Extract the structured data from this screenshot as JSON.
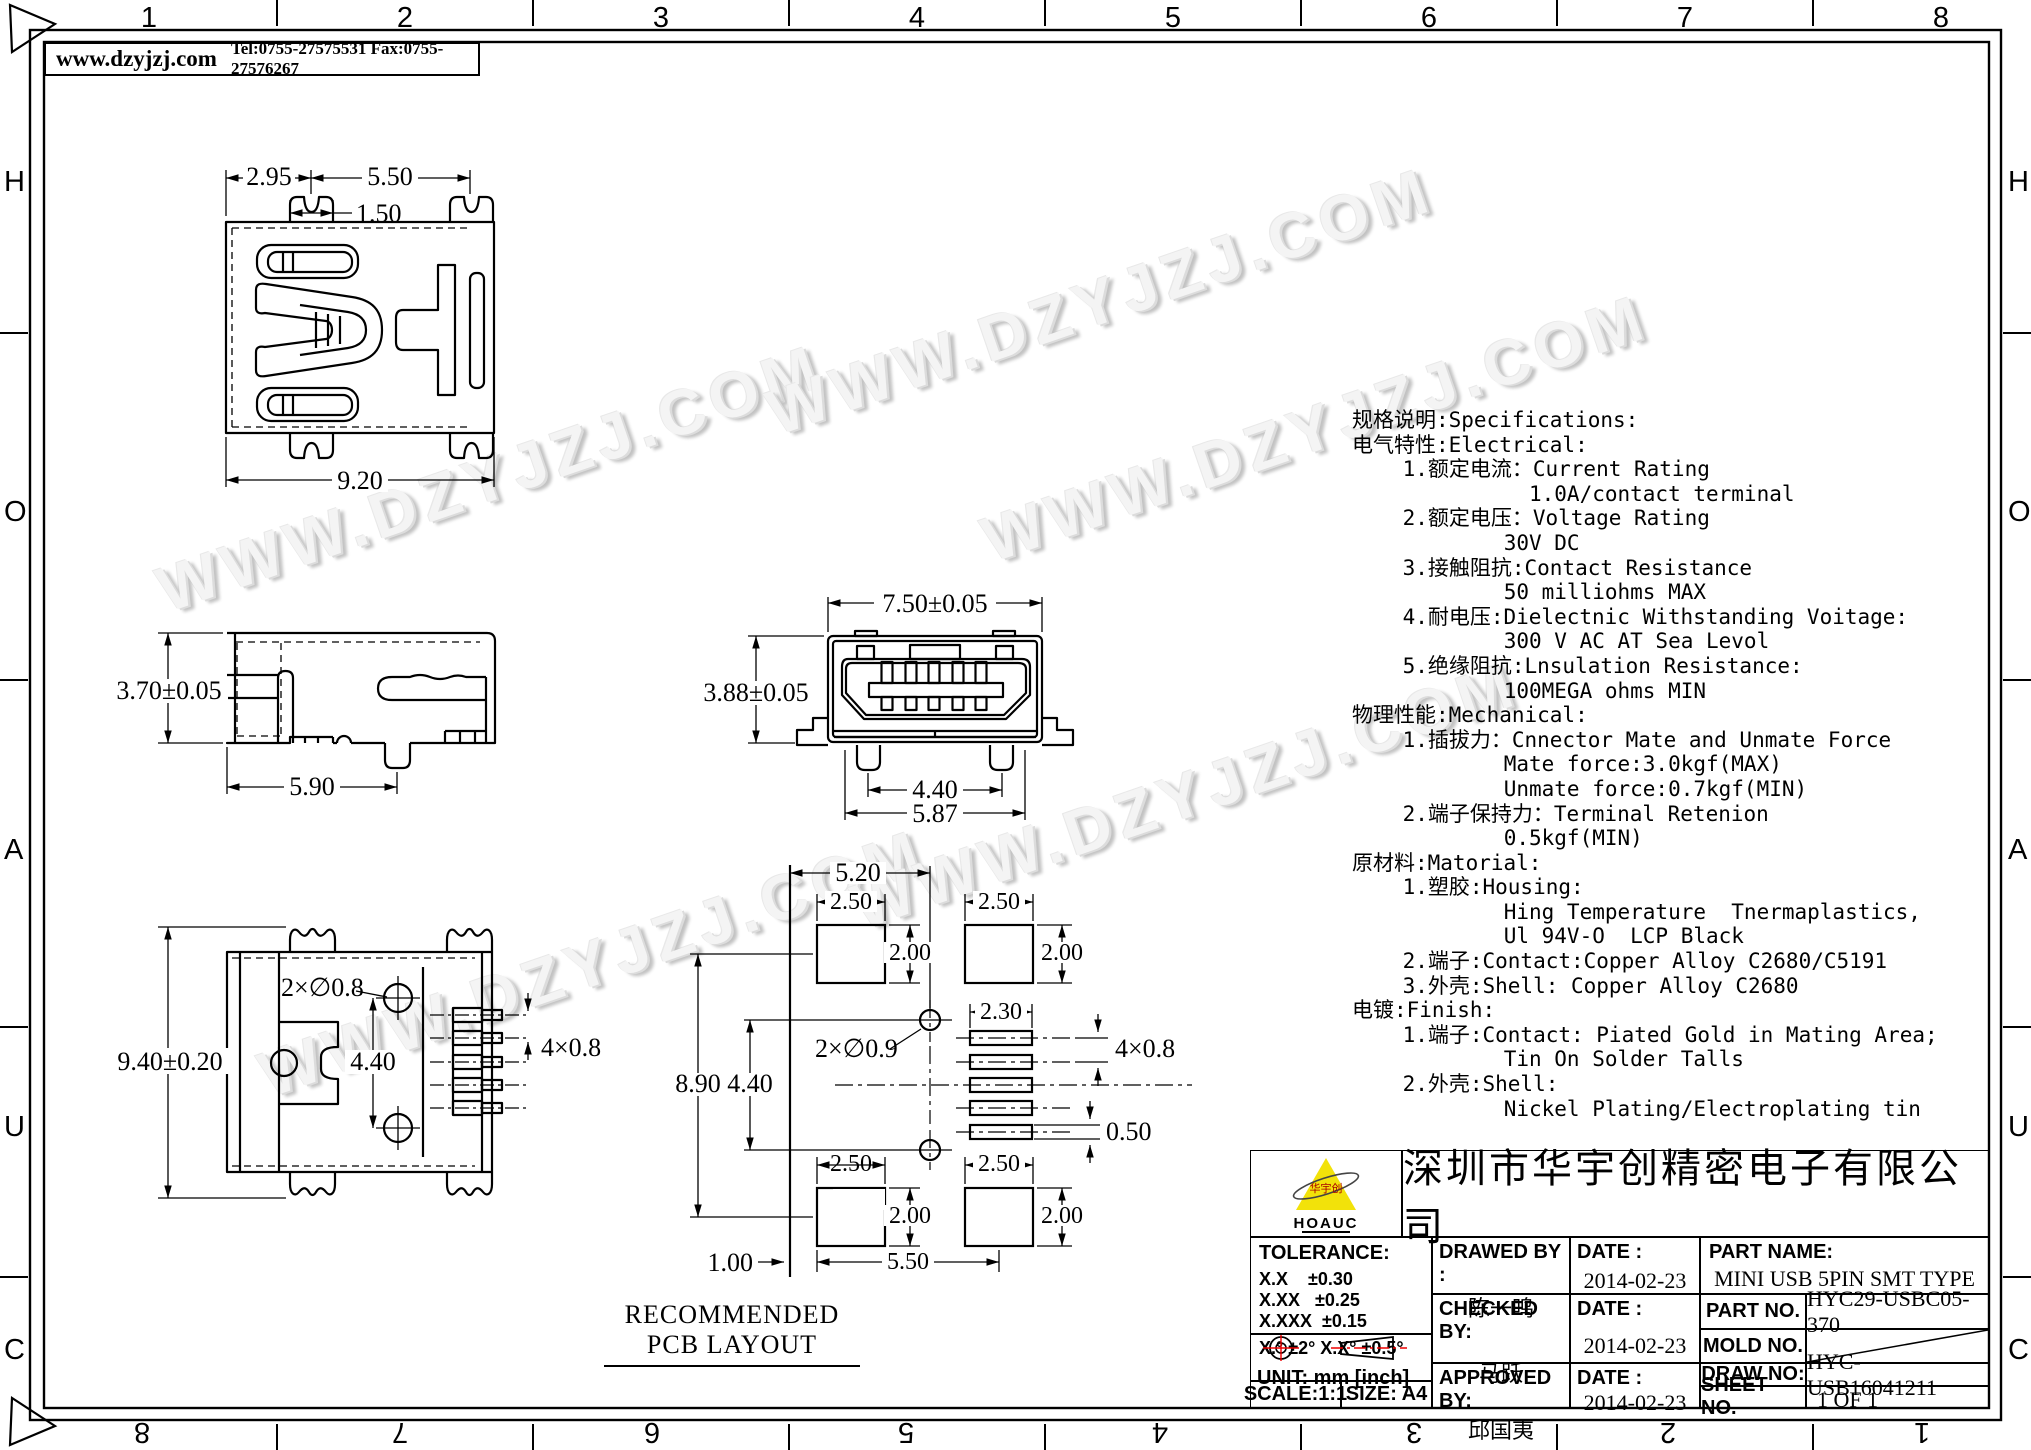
{
  "sheet": {
    "header": {
      "website": "www.dzyjzj.com",
      "contact": "Tel:0755-27575531  Fax:0755-27576267"
    },
    "frame": {
      "top_numbers": [
        "1",
        "2",
        "3",
        "4",
        "5",
        "6",
        "7",
        "8"
      ],
      "bottom_numbers": [
        "8",
        "7",
        "6",
        "5",
        "4",
        "3",
        "2",
        "1"
      ],
      "row_letters": [
        "H",
        "O",
        "A",
        "U",
        "C"
      ]
    },
    "watermark": "WWW.DZYJZJ.COM"
  },
  "views": {
    "top": {
      "d295": "2.95",
      "d550": "5.50",
      "d150": "1.50",
      "d920": "9.20"
    },
    "side": {
      "d370": "3.70±0.05",
      "d590": "5.90"
    },
    "front": {
      "d750": "7.50±0.05",
      "d388": "3.88±0.05",
      "d440": "4.40",
      "d587": "5.87"
    },
    "bottom": {
      "d940": "9.40±0.20",
      "holes": "2×∅0.8",
      "d440": "4.40",
      "pitch": "4×0.8"
    },
    "pcb": {
      "caption": "RECOMMENDED PCB LAYOUT",
      "d520": "5.20",
      "d250": "2.50",
      "d200": "2.00",
      "d230": "2.30",
      "holes": "2×∅0.9",
      "d890": "8.90",
      "d440": "4.40",
      "pitch": "4×0.8",
      "d050": "0.50",
      "d100": "1.00",
      "d550": "5.50"
    }
  },
  "specs": {
    "lines": [
      "规格说明:Specifications:",
      "电气特性:Electrical:",
      "    1.额定电流：Current Rating",
      "              1.0A/contact terminal",
      "    2.额定电压：Voltage Rating",
      "            30V DC",
      "    3.接触阻抗:Contact Resistance",
      "            50 milliohms MAX",
      "    4.耐电压:Dielectnic Withstanding Voitage:",
      "            300 V AC AT Sea Levol",
      "    5.绝缘阻抗:Lnsulation Resistance:",
      "            100MEGA ohms MIN",
      "物理性能:Mechanical:",
      "    1.插拔力：Cnnector Mate and Unmate Force",
      "            Mate force:3.0kgf(MAX)",
      "            Unmate force:0.7kgf(MIN)",
      "    2.端子保持力：Terminal Retenion",
      "            0.5kgf(MIN)",
      "原材料:Matorial:",
      "    1.塑胶:Housing:",
      "            Hing Temperature  Tnermaplastics,",
      "            Ul 94V-O  LCP Black",
      "    2.端子:Contact:Copper Alloy C2680/C5191",
      "    3.外壳:Shell: Copper Alloy C2680",
      "电镀:Finish:",
      "    1.端子:Contact: Piated Gold in Mating Area;",
      "            Tin On Solder Talls",
      "    2.外壳:Shell:",
      "            Nickel Plating/Electroplating tin"
    ]
  },
  "title_block": {
    "logo": {
      "brand": "HOAUC",
      "mark": "华宇创"
    },
    "company": "深圳市华宇创精密电子有限公司",
    "tolerance": {
      "label": "TOLERANCE:",
      "lines": [
        "X.X    ±0.30",
        "X.XX   ±0.25",
        "X.XXX  ±0.15"
      ],
      "angles": "X.° ±2°    X.X° ±0.5°"
    },
    "unit": "UNIT:  mm  [inch]",
    "scale": "SCALE:1:1",
    "size": "SIZE:  A4",
    "date_label": "DATE :",
    "date": "2014-02-23",
    "drawed": {
      "label": "DRAWED BY :",
      "name": "陈一鸣"
    },
    "checked": {
      "label": "CHECKED BY:",
      "name": "马跃"
    },
    "approved": {
      "label": "APPROVED BY:",
      "name": "邱国夷"
    },
    "part_name": {
      "label": "PART NAME:",
      "value": "MINI USB 5PIN SMT TYPE"
    },
    "part_no": {
      "label": "PART NO.",
      "value": "HYC29-USBC05-370"
    },
    "mold_no": {
      "label": "MOLD NO.",
      "value": ""
    },
    "draw_no": {
      "label": "DRAW NO:",
      "value": "HYC-USB16041211"
    },
    "sheet_no": {
      "label": "SHEET NO.",
      "value": "1 OF 1"
    }
  }
}
